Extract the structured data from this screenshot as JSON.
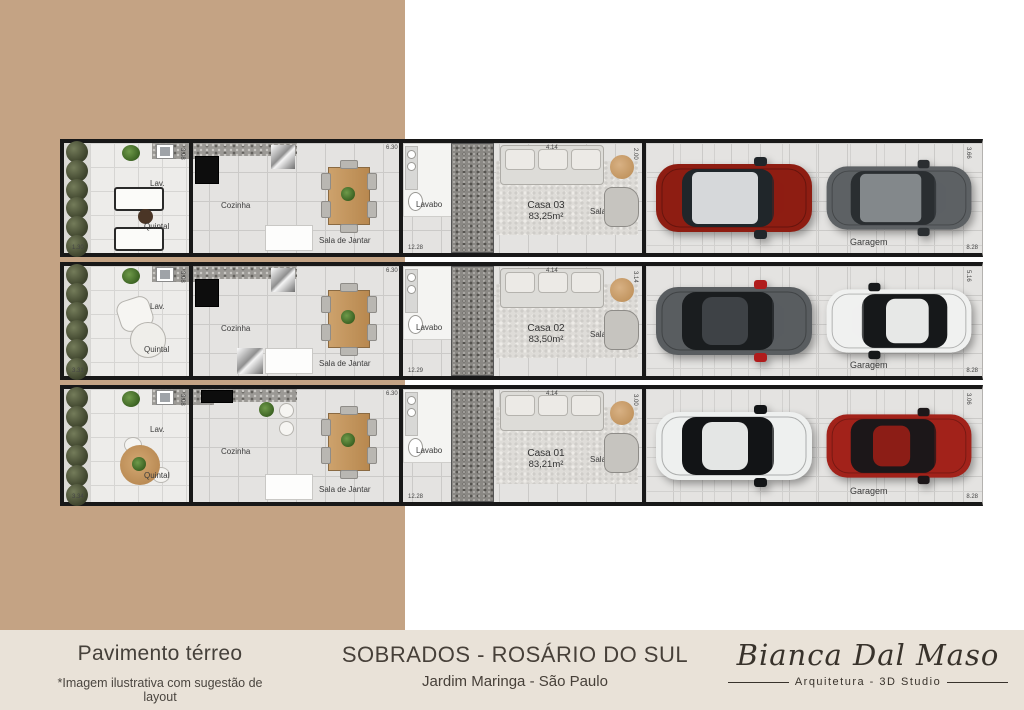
{
  "colors": {
    "backdrop_tan": "#c4a384",
    "footer_cream": "#e9e2d8",
    "wall_black": "#181818",
    "text_dark": "#45403a"
  },
  "footer": {
    "left_title": "Pavimento térreo",
    "left_note": "*Imagem ilustrativa com sugestão de layout",
    "center_title": "SOBRADOS - ROSÁRIO DO SUL",
    "center_subtitle": "Jardim Maringa - São Paulo",
    "logo_name": "Bianca Dal Maso",
    "logo_tagline": "Arquitetura - 3D Studio"
  },
  "room_labels": {
    "lav": "Lav.",
    "quintal": "Quintal",
    "cozinha": "Cozinha",
    "sala_jantar": "Sala de Jantar",
    "lavabo": "Lavabo",
    "sala": "Sala",
    "garagem": "Garagem"
  },
  "units": [
    {
      "id": "casa-03",
      "name": "Casa 03",
      "area": "83,25m²",
      "dims": {
        "front": "6.30",
        "sala_front": "4.14",
        "sala_side": "2.00",
        "depth": "12.28",
        "side_yard": "1.30",
        "lav_side": "3.08",
        "garage_depth": "8.28",
        "garage_side": "3.66"
      },
      "cars": [
        {
          "kind": "suv",
          "body": "#8e1d12",
          "roof": "#d6d8da",
          "glass": "#20262a",
          "facing": "right"
        },
        {
          "kind": "suv",
          "body": "#5d6164",
          "roof": "#83888b",
          "glass": "#2a2e31",
          "facing": "right"
        }
      ]
    },
    {
      "id": "casa-02",
      "name": "Casa 02",
      "area": "83,50m²",
      "dims": {
        "front": "6.30",
        "sala_front": "4.14",
        "sala_side": "3.14",
        "depth": "12.29",
        "side_yard": "3.31",
        "lav_side": "3.08",
        "garage_depth": "8.28",
        "garage_side": "5.16"
      },
      "cars": [
        {
          "kind": "sedan",
          "body": "#595d60",
          "roof": "#3e4246",
          "glass": "#1a1d1f",
          "accent": "#b01c1c",
          "facing": "right"
        },
        {
          "kind": "sedan",
          "body": "#f0f1f0",
          "roof": "#e7e8e7",
          "glass": "#16181a",
          "facing": "left"
        }
      ]
    },
    {
      "id": "casa-01",
      "name": "Casa 01",
      "area": "83,21m²",
      "dims": {
        "front": "6.30",
        "sala_front": "4.14",
        "sala_side": "3.00",
        "depth": "12.28",
        "side_yard": "3.34",
        "lav_side": "3.08",
        "garage_depth": "8.28",
        "garage_side": "3.06"
      },
      "cars": [
        {
          "kind": "sedan",
          "body": "#eef0ef",
          "roof": "#e4e6e5",
          "glass": "#121416",
          "facing": "right"
        },
        {
          "kind": "coupe",
          "body": "#a2221a",
          "roof": "#8c1d16",
          "glass": "#1c1719",
          "facing": "right"
        }
      ]
    }
  ]
}
